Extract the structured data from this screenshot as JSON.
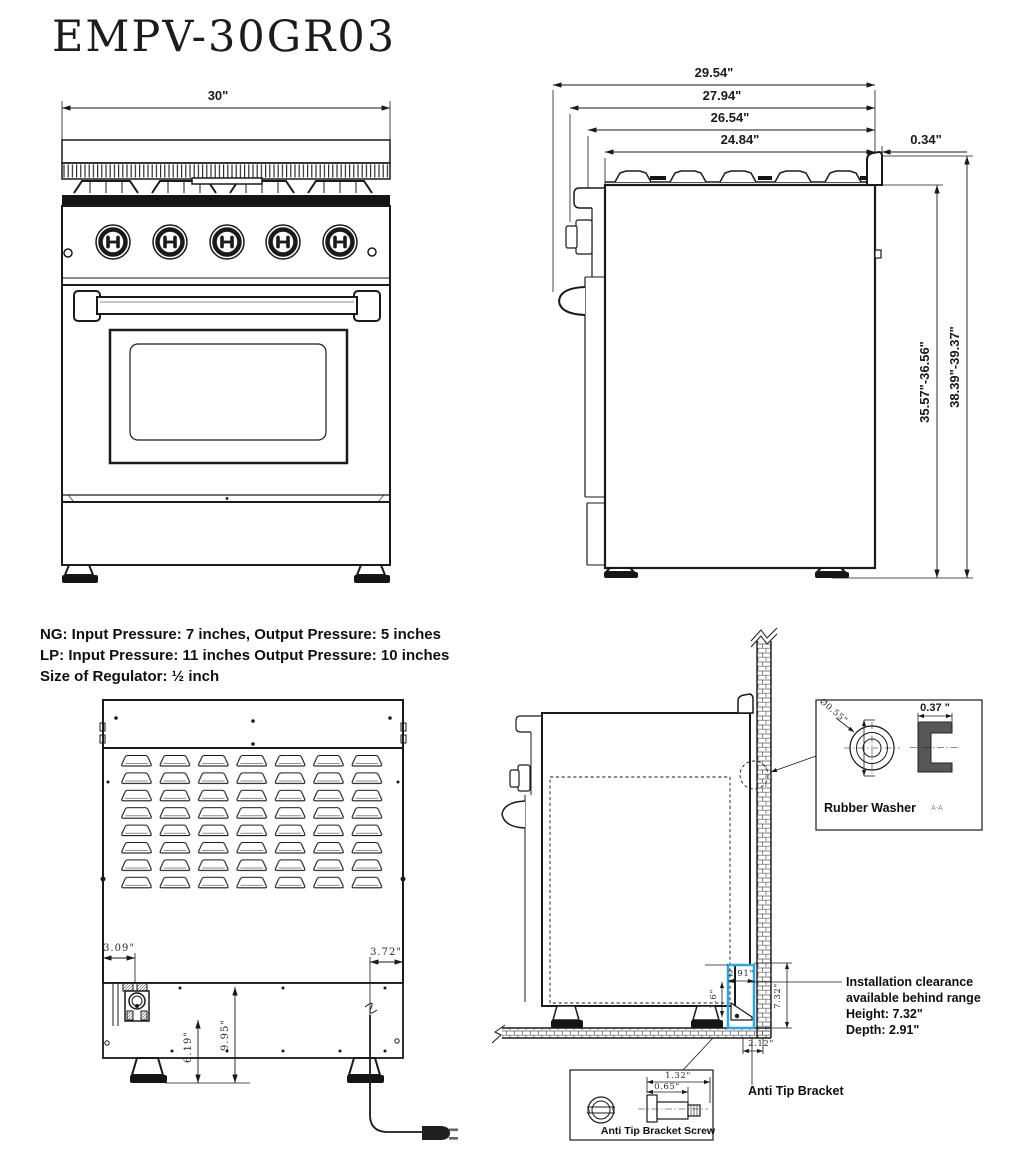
{
  "title": "EMPV-30GR03",
  "colors": {
    "line": "#1a1a1a",
    "highlight": "#2aa7e0"
  },
  "front_view": {
    "dim_width": "30\""
  },
  "side_view": {
    "dim_total_depth": "29.54\"",
    "dim_depth_2": "27.94\"",
    "dim_depth_3": "26.54\"",
    "dim_depth_4": "24.84\"",
    "dim_back_lip": "0.34\"",
    "dim_height_to_top": "35.57\"-36.56\"",
    "dim_height_overall": "38.39\"-39.37\""
  },
  "gas_specs": {
    "line1": "NG: Input Pressure: 7 inches, Output Pressure: 5 inches",
    "line2": "LP: Input Pressure: 11 inches Output Pressure: 10 inches",
    "line3": "Size of Regulator: ½ inch"
  },
  "back_view": {
    "dim_gas_offset": "3.09\"",
    "dim_cord_offset": "3.72\"",
    "dim_gas_height": "6.19\"",
    "dim_panel_height": "9.95\""
  },
  "installation": {
    "dim_clearance_depth": "2.91\"",
    "dim_bracket_height": "1.6\"",
    "dim_clearance_height": "7.32\"",
    "dim_wall_offset": "2.12\"",
    "note_line1": "Installation clearance",
    "note_line2": "available behind range",
    "note_line3": "Height: 7.32\"",
    "note_line4": "Depth: 2.91\"",
    "anti_tip_label": "Anti Tip Bracket"
  },
  "rubber_washer": {
    "dim_diameter": "Ø0.55\"",
    "dim_thickness": "0.37 \"",
    "label": "Rubber Washer",
    "section_label": "A-A"
  },
  "anti_tip_screw": {
    "dim_length": "1.32\"",
    "dim_shank": "0.65\"",
    "label": "Anti Tip Bracket Screw"
  }
}
